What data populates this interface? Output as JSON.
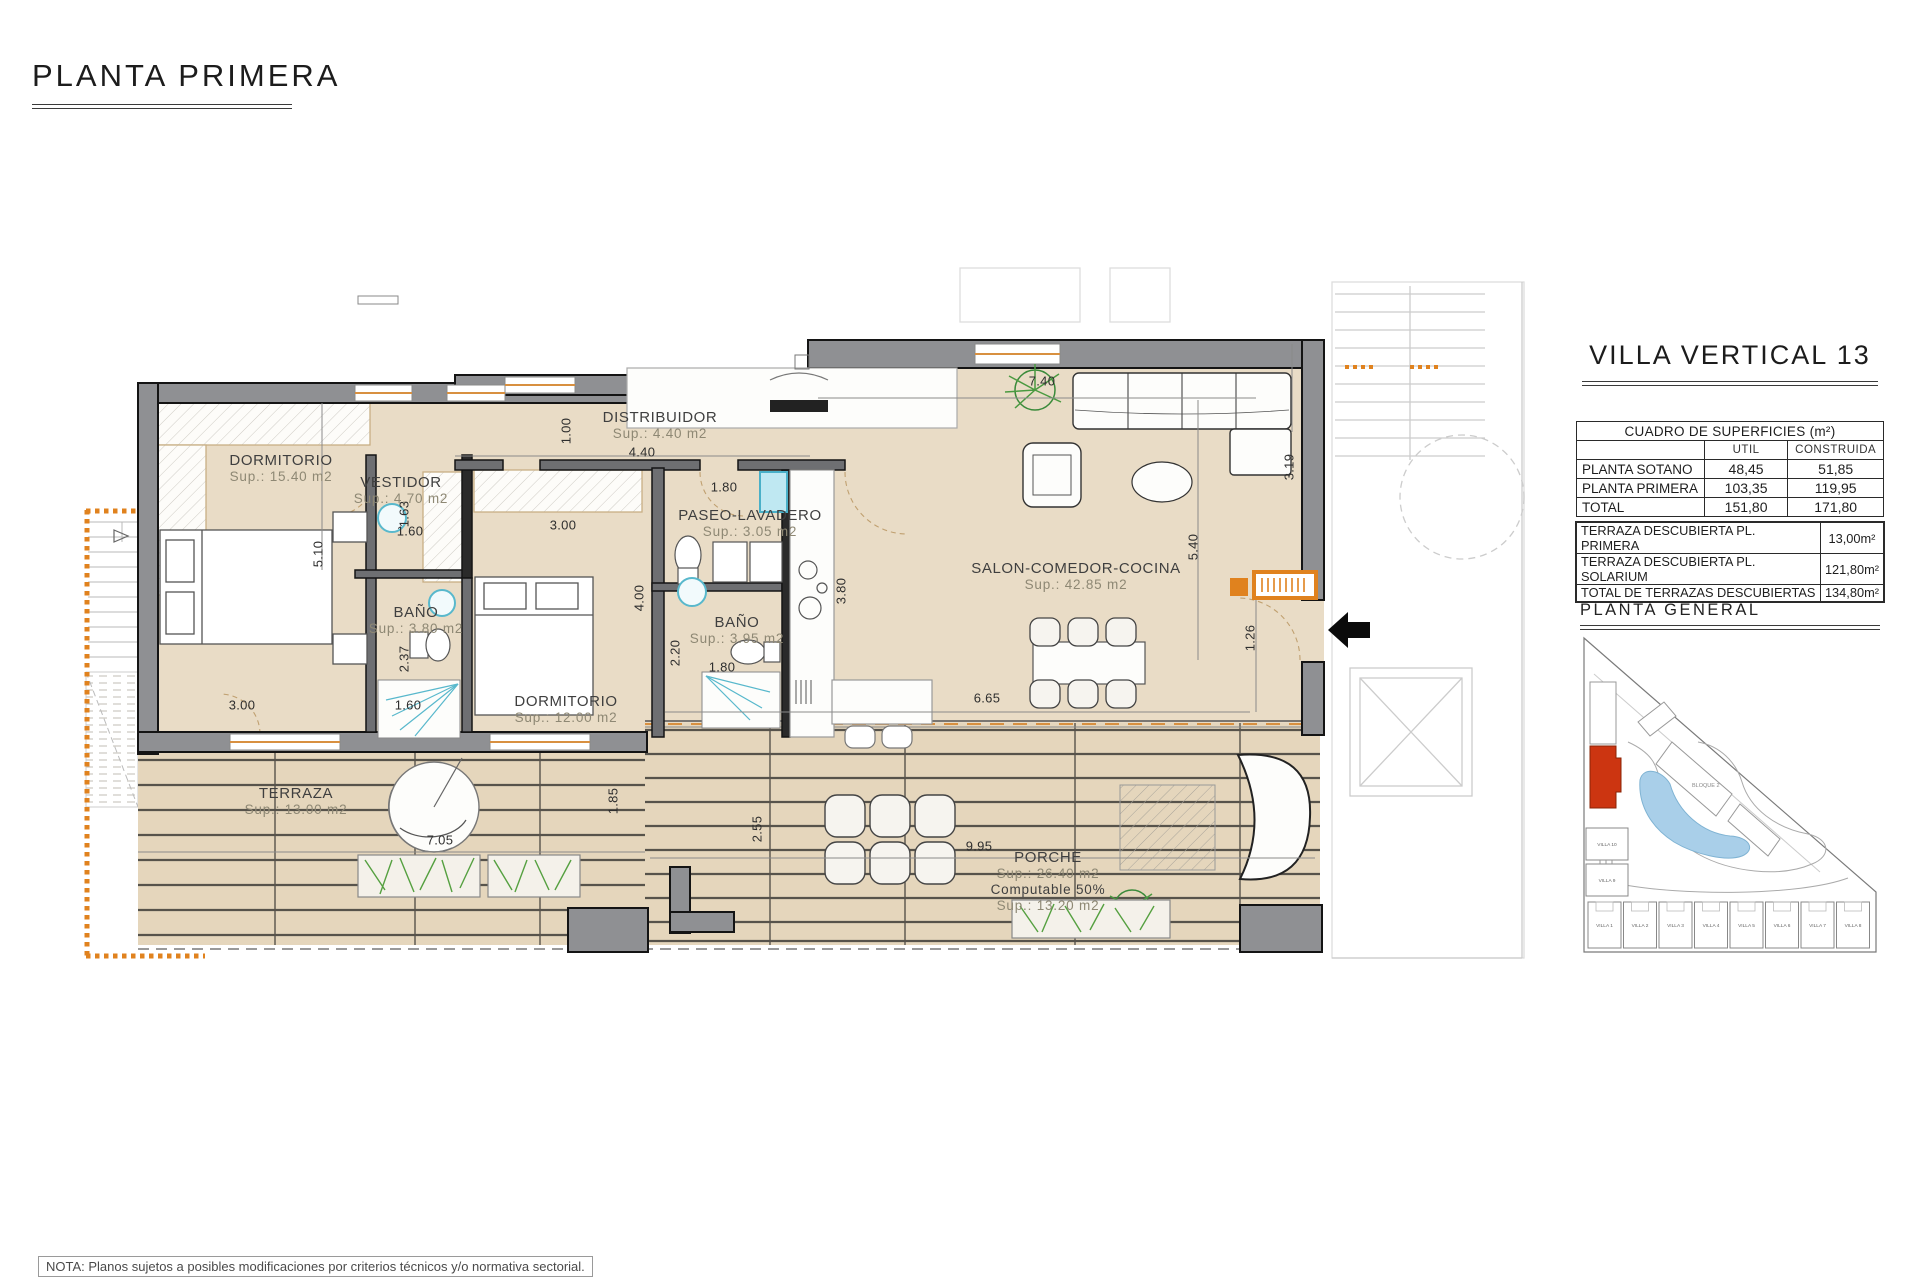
{
  "header": {
    "title": "PLANTA PRIMERA"
  },
  "plan": {
    "rooms": [
      {
        "name": "DORMITORIO",
        "sup": "Sup.: 15.40  m2"
      },
      {
        "name": "VESTIDOR",
        "sup": "Sup.: 4.70  m2"
      },
      {
        "name": "BAÑO",
        "sup": "Sup.: 3.80  m2"
      },
      {
        "name": "DORMITORIO",
        "sup": "Sup.: 12.00  m2"
      },
      {
        "name": "DISTRIBUIDOR",
        "sup": "Sup.: 4.40  m2"
      },
      {
        "name": "PASEO-LAVADERO",
        "sup": "Sup.: 3.05  m2"
      },
      {
        "name": "BAÑO",
        "sup": "Sup.: 3.95  m2"
      },
      {
        "name": "SALON-COMEDOR-COCINA",
        "sup": "Sup.: 42.85 m2"
      },
      {
        "name": "TERRAZA",
        "sup": "Sup.: 13.00 m2"
      },
      {
        "name": "PORCHE",
        "sup": "Sup.: 26.40 m2",
        "extra1": "Computable 50%",
        "extra2": "Sup.: 13.20 m2"
      }
    ],
    "dims": [
      "7.40",
      "3.19",
      "5.40",
      "1.26",
      "6.65",
      "9.95",
      "2.55",
      "1.85",
      "7.05",
      "3.00",
      "5.10",
      "1.63",
      "1.60",
      "3.00",
      "2.37",
      "1.60",
      "1.00",
      "4.40",
      "1.80",
      "4.00",
      "2.20",
      "1.80",
      "3.80"
    ]
  },
  "sidebar": {
    "villa_title": "VILLA VERTICAL 13",
    "surfaces": {
      "title": "CUADRO DE SUPERFICIES (m²)",
      "col_util": "UTIL",
      "col_construida": "CONSTRUIDA",
      "rows": [
        {
          "label": "PLANTA SOTANO",
          "util": "48,45",
          "construida": "51,85"
        },
        {
          "label": "PLANTA PRIMERA",
          "util": "103,35",
          "construida": "119,95"
        },
        {
          "label": "TOTAL",
          "util": "151,80",
          "construida": "171,80"
        }
      ]
    },
    "terraces": {
      "rows": [
        {
          "label": "TERRAZA DESCUBIERTA PL. PRIMERA",
          "value": "13,00m²"
        },
        {
          "label": "TERRAZA DESCUBIERTA PL. SOLARIUM",
          "value": "121,80m²"
        },
        {
          "label": "TOTAL DE TERRAZAS DESCUBIERTAS",
          "value": "134,80m²"
        }
      ]
    },
    "site": {
      "title": "PLANTA GENERAL",
      "bloque": "BLOQUE 2",
      "left_villas": [
        "VILLA 10",
        "VILLA 9"
      ],
      "villas": [
        "VILLA 1",
        "VILLA 2",
        "VILLA 3",
        "VILLA 4",
        "VILLA 5",
        "VILLA 6",
        "VILLA 7",
        "VILLA 8"
      ]
    }
  },
  "footer": {
    "note": "NOTA: Planos sujetos a posibles modificaciones por criterios técnicos y/o normativa sectorial."
  }
}
